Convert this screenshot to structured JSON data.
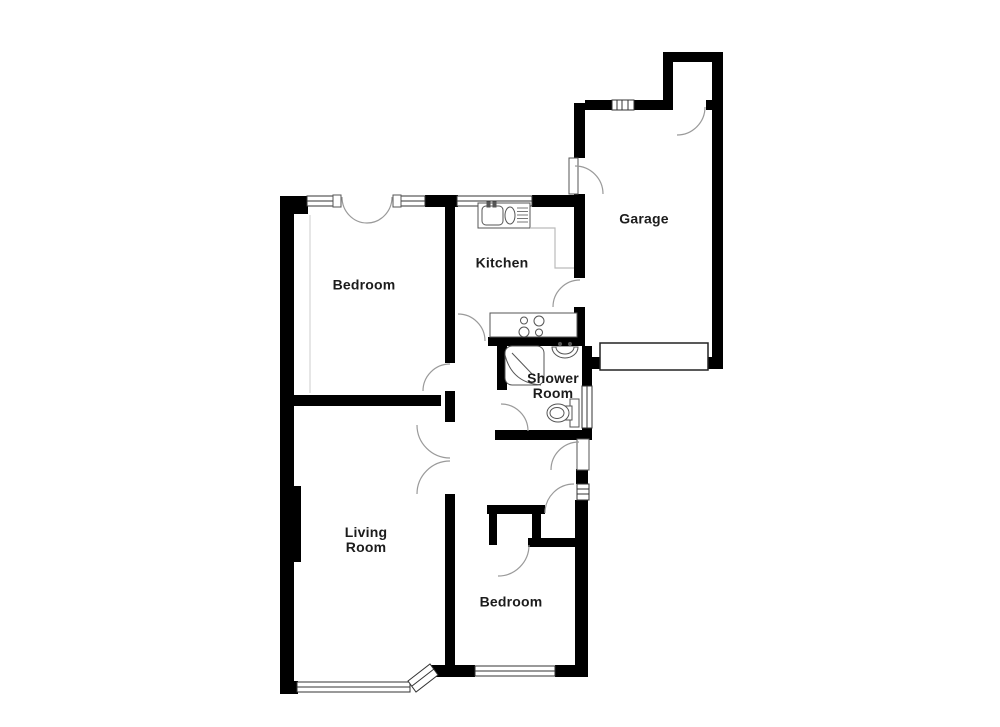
{
  "plan": {
    "type": "floor-plan",
    "background_color": "#ffffff",
    "wall_color": "#000000",
    "door_arc_color": "#9a9a9a",
    "window_line_color": "#333333",
    "label_color": "#1c1c1c",
    "rooms": [
      {
        "id": "bedroom-top",
        "line1": "Bedroom",
        "line2": ""
      },
      {
        "id": "kitchen",
        "line1": "Kitchen",
        "line2": ""
      },
      {
        "id": "garage",
        "line1": "Garage",
        "line2": ""
      },
      {
        "id": "shower-room",
        "line1": "Shower",
        "line2": "Room"
      },
      {
        "id": "living-room",
        "line1": "Living",
        "line2": "Room"
      },
      {
        "id": "bedroom-bottom",
        "line1": "Bedroom",
        "line2": ""
      }
    ],
    "fixtures": [
      "kitchen-sink-drainer-unit",
      "kitchen-worktop",
      "cooker-hob",
      "shower-enclosure",
      "washbasin",
      "toilet",
      "garage-door",
      "wardrobe-line",
      "chimney-breast"
    ],
    "door_count": 13,
    "window_count": 9
  }
}
